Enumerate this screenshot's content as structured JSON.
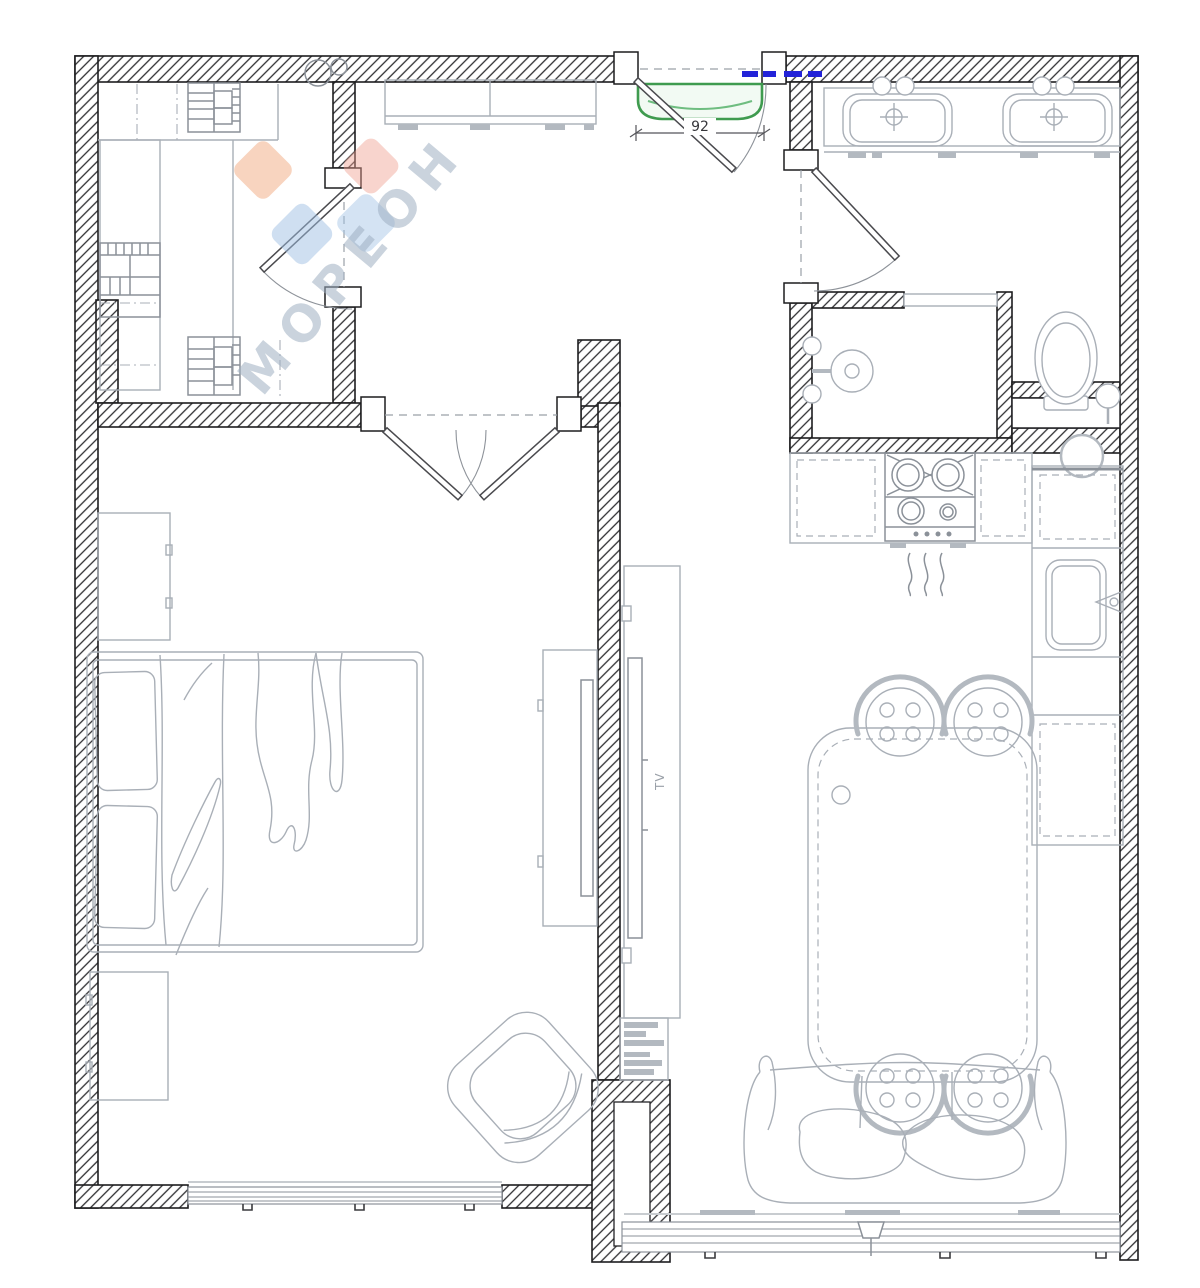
{
  "plan": {
    "dimension_label": "92",
    "tv_label": "TV",
    "watermark": {
      "text": "МОРЕОН"
    },
    "colors": {
      "wall_line": "#1d1d1f",
      "furniture_line": "#a9afb7",
      "furniture_line_dark": "#8b9199",
      "furniture_fill": "#b3b9c0",
      "entry_mat_green": "#3f9b4f",
      "entry_mat_green_light": "#6fbd80",
      "electric_blue": "#2323d8",
      "watermark_text": "#9fb0c2",
      "watermark_orange": "#f2a97f",
      "watermark_orange2": "#efa090",
      "watermark_blue": "#9fc0e4",
      "floor_gray": "#c8ccd0"
    },
    "symbols": [
      "entry-door",
      "entry-mat",
      "wardrobe-room-door",
      "bedroom-double-door",
      "bathroom-door",
      "double-sink-vanity",
      "shower",
      "toilet",
      "gas-stove",
      "kitchen-sink",
      "dining-table",
      "chairs",
      "bed",
      "nightstands",
      "armchair",
      "tv-dresser",
      "tv-panel",
      "bookshelf",
      "sofa",
      "windows",
      "ceiling-lamp",
      "hall-cabinet"
    ]
  }
}
